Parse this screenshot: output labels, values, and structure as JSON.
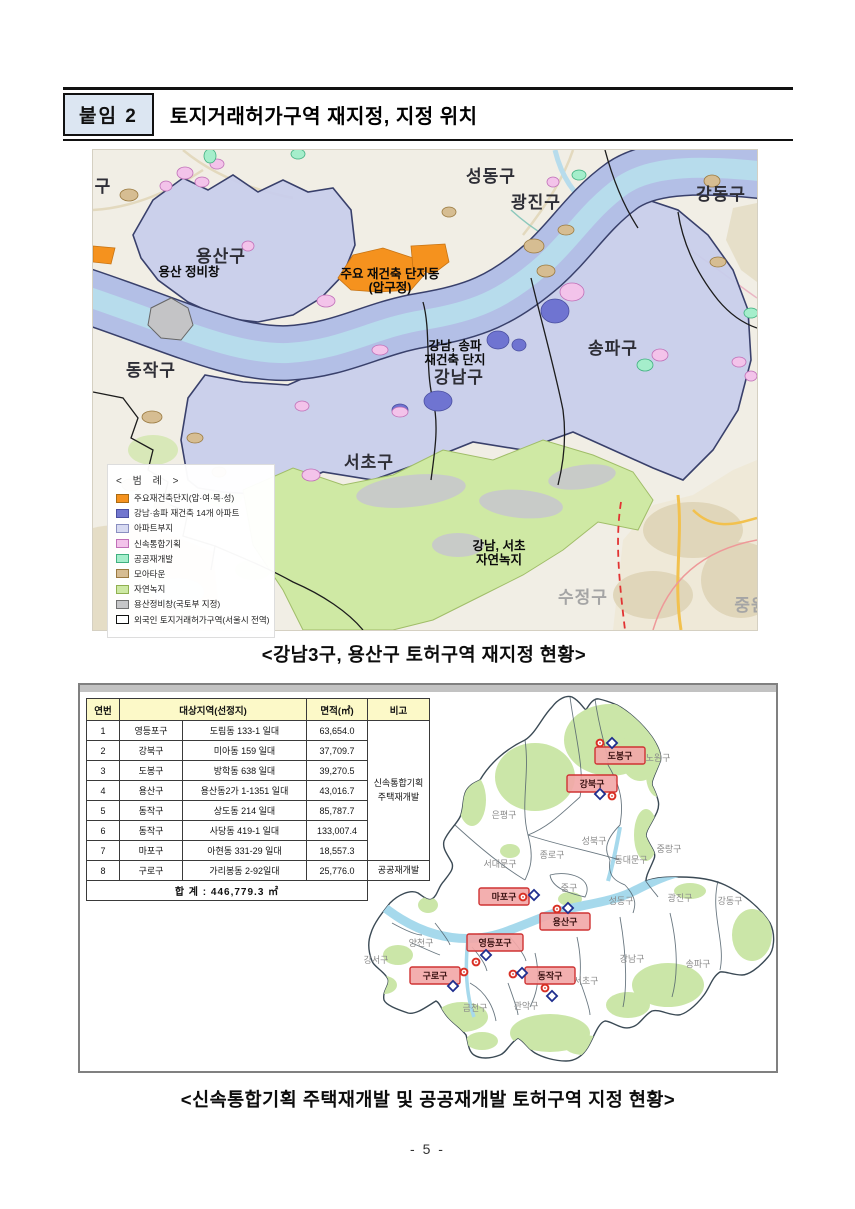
{
  "page": {
    "badge": "붙임 2",
    "title": "토지거래허가구역 재지정, 지정 위치",
    "page_number": "- 5 -"
  },
  "figure1": {
    "caption": "<강남3구, 용산구 토허구역 재지정 현황>",
    "legend": {
      "title": "< 범   례 >",
      "items": [
        {
          "label": "주요재건축단지(압·여·목·성)",
          "color": "#f5921e",
          "border": "#a86a14"
        },
        {
          "label": "강남·송파 재건축 14개 아파트",
          "color": "#7277cf",
          "border": "#4a4fa0"
        },
        {
          "label": "아파트부지",
          "color": "#d7daf2",
          "border": "#8a8fc0"
        },
        {
          "label": "신속통합기획",
          "color": "#f3c3ea",
          "border": "#c070b8"
        },
        {
          "label": "공공재개발",
          "color": "#a5eecb",
          "border": "#40b080"
        },
        {
          "label": "모아타운",
          "color": "#d6bd92",
          "border": "#9a7a40"
        },
        {
          "label": "자연녹지",
          "color": "#cde9a3",
          "border": "#90b050"
        },
        {
          "label": "용산정비창(국토부 지정)",
          "color": "#c6c6c8",
          "border": "#707070"
        },
        {
          "label": "외국인 토지거래허가구역(서울시 전역)",
          "color": "#ffffff",
          "border": "#111111"
        }
      ]
    },
    "districts": [
      {
        "t": "용산구",
        "x": 128,
        "y": 112
      },
      {
        "t": "성동구",
        "x": 398,
        "y": 32
      },
      {
        "t": "광진구",
        "x": 443,
        "y": 58
      },
      {
        "t": "강동구",
        "x": 628,
        "y": 50
      },
      {
        "t": "동작구",
        "x": 58,
        "y": 226
      },
      {
        "t": "강남구",
        "x": 366,
        "y": 233
      },
      {
        "t": "송파구",
        "x": 520,
        "y": 204
      },
      {
        "t": "서초구",
        "x": 276,
        "y": 318
      },
      {
        "t": "구",
        "x": 10,
        "y": 42
      }
    ],
    "neighbors": [
      {
        "t": "수정구",
        "x": 490,
        "y": 453
      },
      {
        "t": "중원",
        "x": 658,
        "y": 461
      }
    ],
    "annotations": [
      {
        "lines": [
          "용산 정비창"
        ],
        "x": 96,
        "y": 126
      },
      {
        "lines": [
          "주요 재건축 단지동",
          "(압구정)"
        ],
        "x": 297,
        "y": 128
      },
      {
        "lines": [
          "강남, 송파",
          "재건축 단지"
        ],
        "x": 362,
        "y": 200
      },
      {
        "lines": [
          "강남, 서초",
          "자연녹지"
        ],
        "x": 406,
        "y": 400
      }
    ]
  },
  "figure2": {
    "caption": "<신속통합기획 주택재개발 및 공공재개발 토허구역 지정 현황>",
    "table": {
      "headers": [
        "연번",
        "대상지역(선정지)",
        "면적(㎡)",
        "비고"
      ],
      "rows": [
        [
          "1",
          "영등포구",
          "도림동 133-1 일대",
          "63,654.0"
        ],
        [
          "2",
          "강북구",
          "미아동 159 일대",
          "37,709.7"
        ],
        [
          "3",
          "도봉구",
          "방학동 638 일대",
          "39,270.5"
        ],
        [
          "4",
          "용산구",
          "용산동2가 1-1351 일대",
          "43,016.7"
        ],
        [
          "5",
          "동작구",
          "상도동 214 일대",
          "85,787.7"
        ],
        [
          "6",
          "동작구",
          "사당동 419-1 일대",
          "133,007.4"
        ],
        [
          "7",
          "마포구",
          "아현동 331-29 일대",
          "18,557.3"
        ],
        [
          "8",
          "구로구",
          "가리봉동 2-92일대",
          "25,776.0"
        ]
      ],
      "remark_group": [
        "신속통합기획",
        "주택재개발"
      ],
      "remark_last": "공공재개발",
      "total": "합  계 : 446,779.3 ㎡"
    },
    "map": {
      "boxes": [
        {
          "t": "도봉구",
          "x": 515,
          "y": 62,
          "w": 50
        },
        {
          "t": "강북구",
          "x": 487,
          "y": 90,
          "w": 50
        },
        {
          "t": "마포구",
          "x": 399,
          "y": 203,
          "w": 50
        },
        {
          "t": "용산구",
          "x": 460,
          "y": 228,
          "w": 50
        },
        {
          "t": "영등포구",
          "x": 387,
          "y": 249,
          "w": 56
        },
        {
          "t": "구로구",
          "x": 330,
          "y": 282,
          "w": 50
        },
        {
          "t": "동작구",
          "x": 445,
          "y": 282,
          "w": 50
        }
      ],
      "labels": [
        {
          "t": "노원구",
          "x": 578,
          "y": 76
        },
        {
          "t": "은평구",
          "x": 424,
          "y": 133
        },
        {
          "t": "성북구",
          "x": 514,
          "y": 159
        },
        {
          "t": "중랑구",
          "x": 589,
          "y": 167
        },
        {
          "t": "종로구",
          "x": 472,
          "y": 173
        },
        {
          "t": "서대문구",
          "x": 420,
          "y": 182
        },
        {
          "t": "동대문구",
          "x": 551,
          "y": 178
        },
        {
          "t": "중구",
          "x": 489,
          "y": 206
        },
        {
          "t": "성동구",
          "x": 541,
          "y": 219
        },
        {
          "t": "광진구",
          "x": 600,
          "y": 216
        },
        {
          "t": "강동구",
          "x": 650,
          "y": 219
        },
        {
          "t": "강남구",
          "x": 552,
          "y": 277
        },
        {
          "t": "송파구",
          "x": 618,
          "y": 282
        },
        {
          "t": "서초구",
          "x": 506,
          "y": 299
        },
        {
          "t": "관악구",
          "x": 446,
          "y": 324
        },
        {
          "t": "금천구",
          "x": 395,
          "y": 326
        },
        {
          "t": "양천구",
          "x": 341,
          "y": 261
        },
        {
          "t": "강서구",
          "x": 296,
          "y": 278
        }
      ],
      "markers": [
        {
          "k": "c",
          "x": 520,
          "y": 58
        },
        {
          "k": "d",
          "x": 532,
          "y": 58
        },
        {
          "k": "d",
          "x": 520,
          "y": 109
        },
        {
          "k": "c",
          "x": 532,
          "y": 111
        },
        {
          "k": "c",
          "x": 443,
          "y": 212
        },
        {
          "k": "d",
          "x": 454,
          "y": 210
        },
        {
          "k": "c",
          "x": 477,
          "y": 224
        },
        {
          "k": "d",
          "x": 488,
          "y": 223
        },
        {
          "k": "d",
          "x": 406,
          "y": 270
        },
        {
          "k": "c",
          "x": 396,
          "y": 277
        },
        {
          "k": "c",
          "x": 384,
          "y": 287
        },
        {
          "k": "d",
          "x": 373,
          "y": 301
        },
        {
          "k": "c",
          "x": 433,
          "y": 289
        },
        {
          "k": "d",
          "x": 442,
          "y": 288
        },
        {
          "k": "c",
          "x": 465,
          "y": 303
        },
        {
          "k": "d",
          "x": 472,
          "y": 311
        }
      ]
    }
  }
}
